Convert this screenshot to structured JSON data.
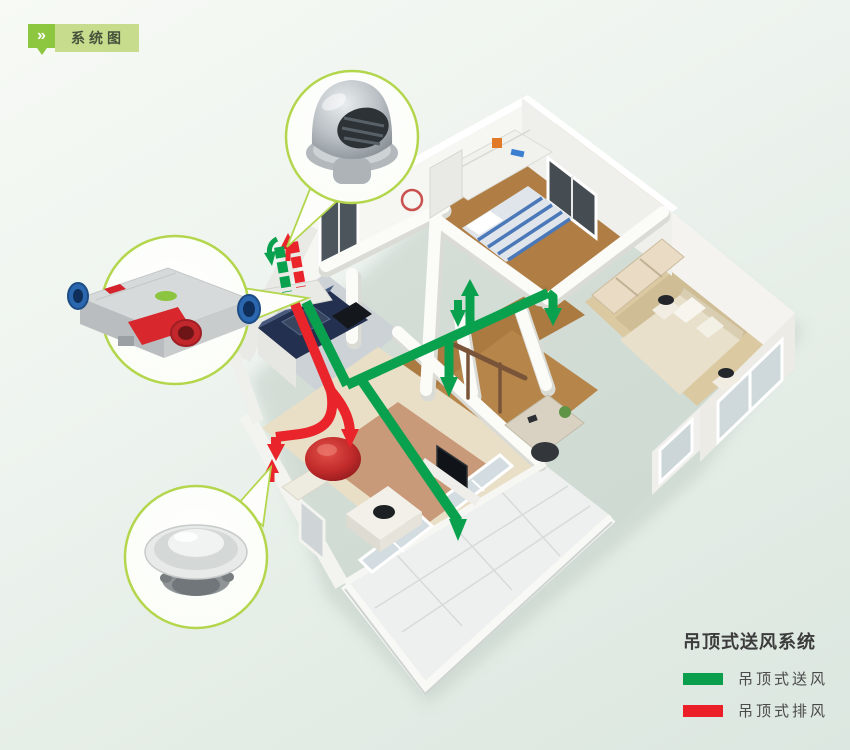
{
  "header": {
    "badge_label": "系统图",
    "badge_icon": "double-chevron-right-icon",
    "badge_chevron": "»"
  },
  "colors": {
    "supply": "#0aa14e",
    "exhaust": "#e9242b",
    "callout_border": "#b3d64d",
    "badge_green": "#8dc63f",
    "badge_light_green": "#c7dd8d"
  },
  "legend": {
    "title": "吊顶式送风系统",
    "items": [
      {
        "label": "吊顶式送风",
        "color": "#0b9f4d"
      },
      {
        "label": "吊顶式排风",
        "color": "#ea1f27"
      }
    ]
  },
  "callouts": {
    "top": {
      "name": "outdoor-vent-hood"
    },
    "middle": {
      "name": "heat-recovery-ventilator-unit"
    },
    "bottom": {
      "name": "ceiling-diffuser"
    }
  },
  "diagram": {
    "type": "ceiling-mounted ventilation system, isometric apartment cutaway",
    "supply_duct": "green duct from wall unit through corridor with outlets to bedrooms, study and living room balcony door",
    "exhaust_duct": "red duct from kitchen/living area exhaust hood back out through exterior wall"
  }
}
